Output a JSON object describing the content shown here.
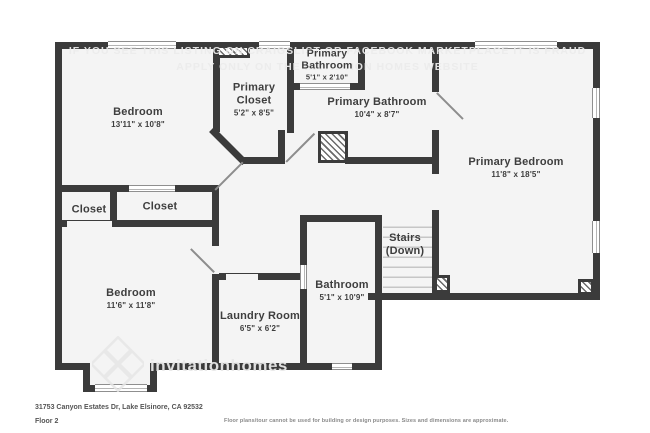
{
  "floorplan": {
    "rooms": [
      {
        "name": "Bedroom",
        "dims": "13'11\" x 10'8\""
      },
      {
        "name": "Primary Closet",
        "dims": "5'2\" x 8'5\""
      },
      {
        "name": "Primary Bathroom",
        "dims": "5'1\" x 2'10\""
      },
      {
        "name": "Primary Bathroom",
        "dims": "10'4\" x 8'7\""
      },
      {
        "name": "Primary Bedroom",
        "dims": "11'8\" x 18'5\""
      },
      {
        "name": "Closet",
        "dims": ""
      },
      {
        "name": "Closet",
        "dims": ""
      },
      {
        "name": "Bedroom",
        "dims": "11'6\" x 11'8\""
      },
      {
        "name": "Laundry Room",
        "dims": "6'5\" x 6'2\""
      },
      {
        "name": "Bathroom",
        "dims": "5'1\" x 10'9\""
      },
      {
        "name": "Stairs",
        "dims": "(Down)"
      }
    ],
    "watermark": {
      "line1": "IF YOU SEE THIS LISTING ON CRAIGSLIST OR FACEBOOK MARKETPLACE IT IS FRAUD",
      "line2": "APPLY ONLY ON THE INVITATION HOMES WEBSITE",
      "brand": "invitationhomes",
      "logo_icon": "invitation-homes-diamond-logo"
    },
    "colors": {
      "wall": "#3b3b3b",
      "room_fill": "#f4f4f4",
      "label_text": "#3e3e3e"
    }
  },
  "footer": {
    "address": "31753 Canyon Estates Dr, Lake Elsinore, CA 92532",
    "floor_label": "Floor 2",
    "disclaimer": "Floor plans/tour cannot be used for building or design purposes. Sizes and dimensions are approximate."
  }
}
